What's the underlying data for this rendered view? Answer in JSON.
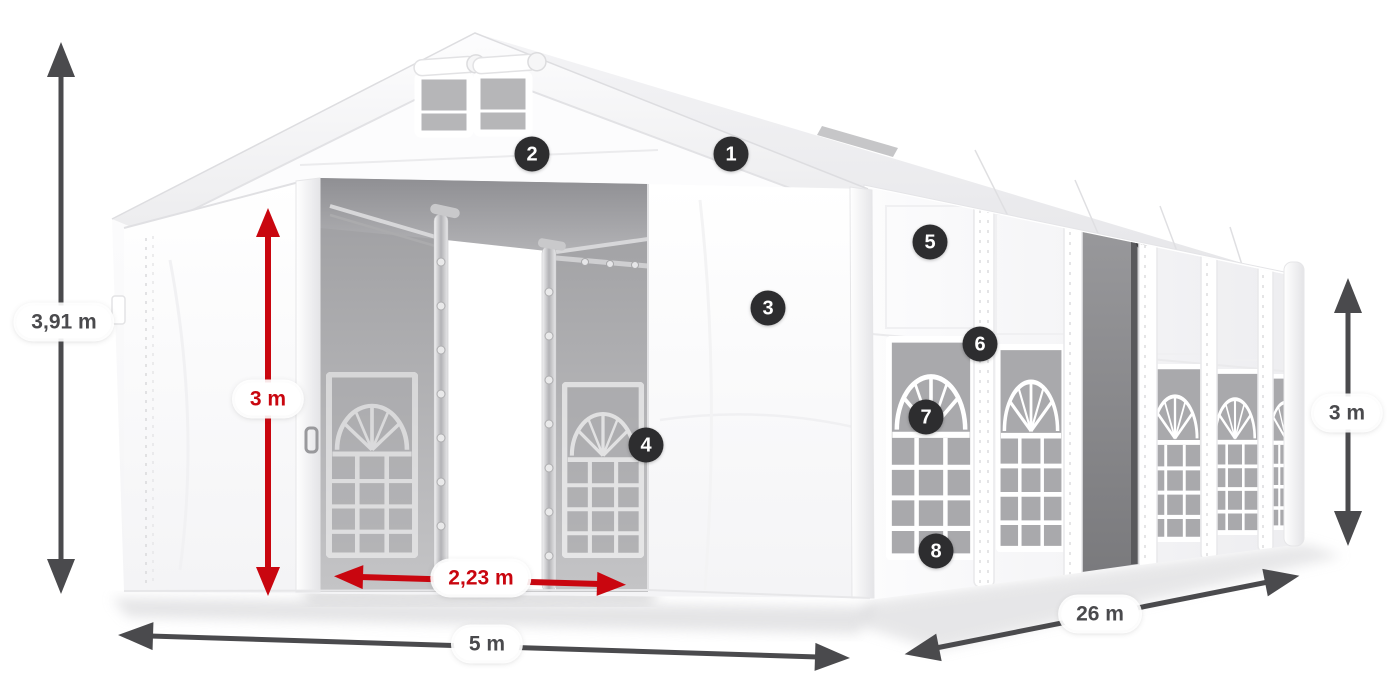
{
  "colors": {
    "canvas_background": "#ffffff",
    "dimension_gray": "#4a4a4d",
    "dimension_red": "#c9060f",
    "badge_background": "#2d2d2f",
    "badge_text": "#ffffff",
    "pill_background": "#ffffff"
  },
  "dimensions": {
    "overall_height": {
      "value": "3,91 m",
      "style": "gray",
      "axis": "vertical-left"
    },
    "entrance_height": {
      "value": "3 m",
      "style": "red",
      "axis": "vertical-front-door"
    },
    "entrance_width": {
      "value": "2,23 m",
      "style": "red",
      "axis": "horizontal-front-door"
    },
    "front_width": {
      "value": "5 m",
      "style": "gray",
      "axis": "horizontal-front-base"
    },
    "side_length": {
      "value": "26 m",
      "style": "gray",
      "axis": "diagonal-side-base"
    },
    "side_wall_height": {
      "value": "3 m",
      "style": "gray",
      "axis": "vertical-right"
    }
  },
  "callouts": {
    "items": [
      {
        "number": "1"
      },
      {
        "number": "2"
      },
      {
        "number": "3"
      },
      {
        "number": "4"
      },
      {
        "number": "5"
      },
      {
        "number": "6"
      },
      {
        "number": "7"
      },
      {
        "number": "8"
      }
    ]
  }
}
